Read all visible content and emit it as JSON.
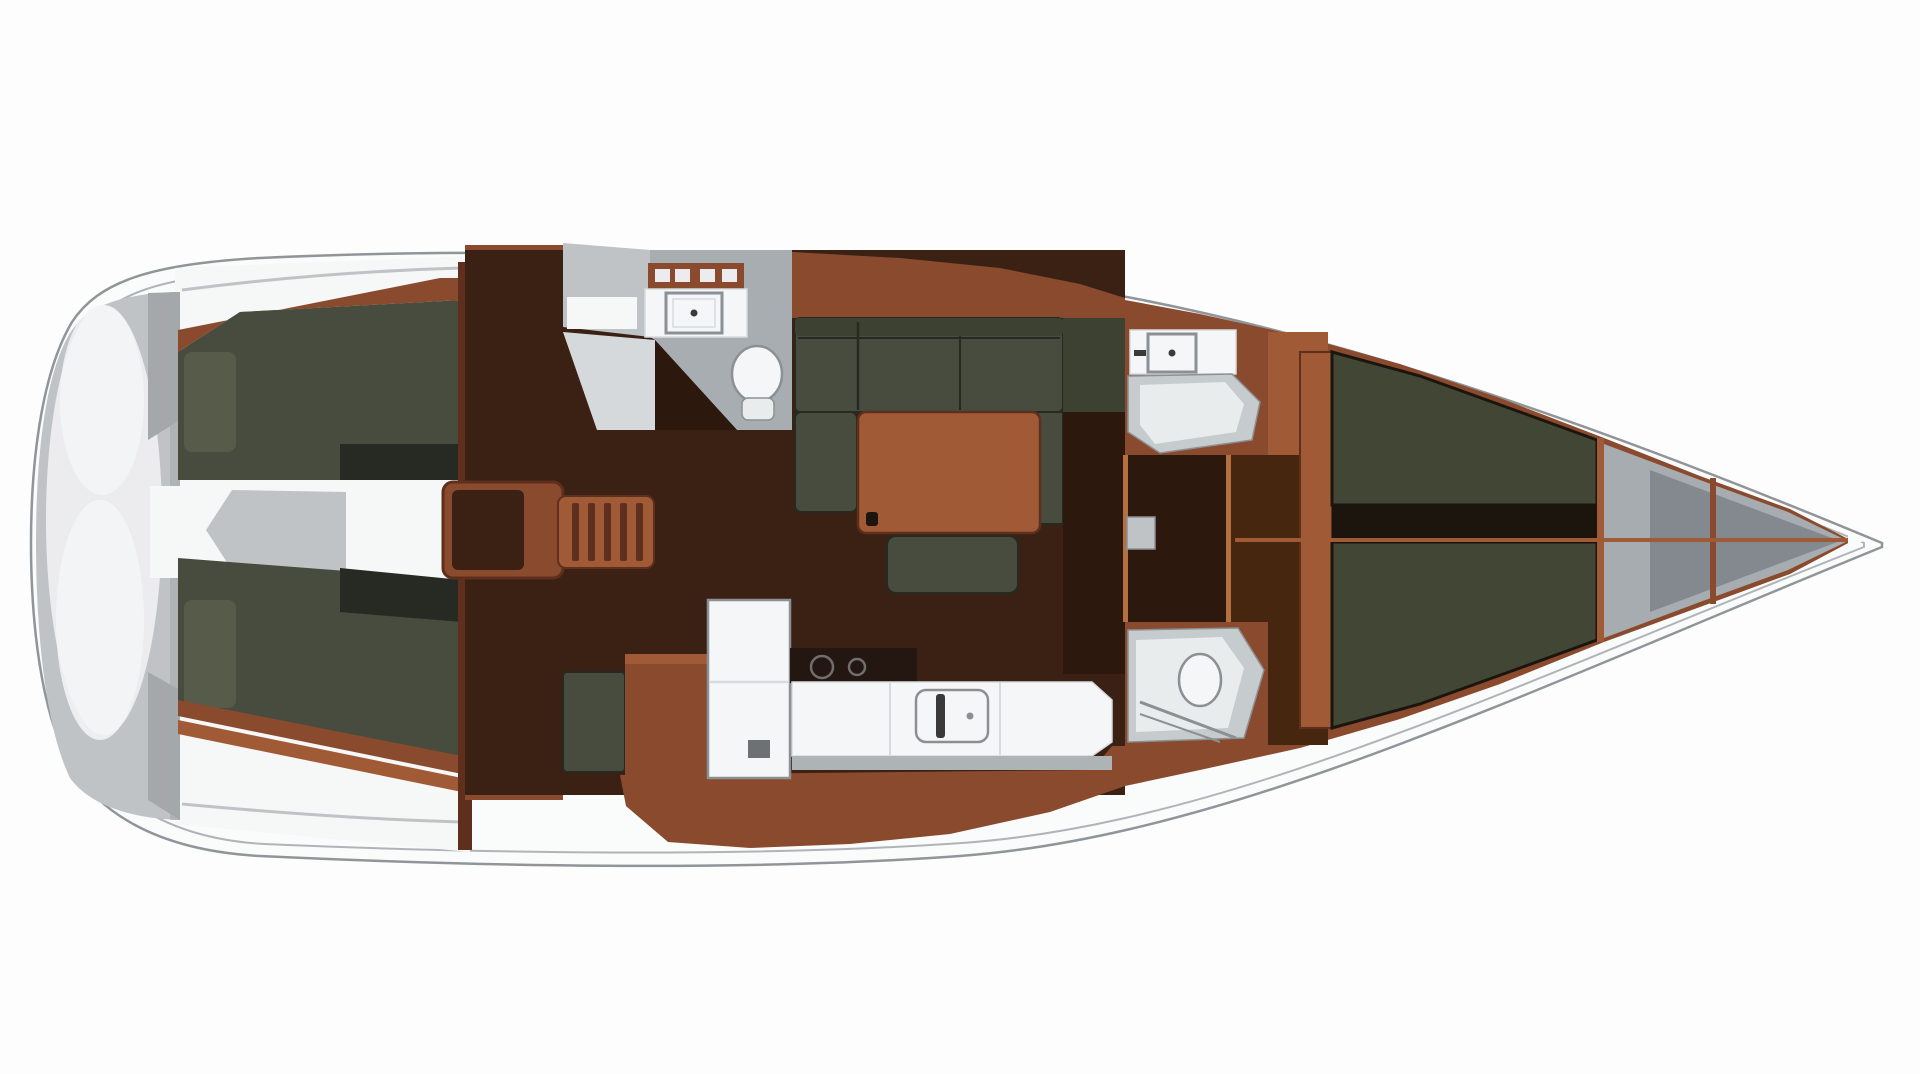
{
  "plan": {
    "type": "yacht-interior-floor-plan",
    "view": "top-down",
    "regions": [
      "stern-platform",
      "port-aft-cabin",
      "starboard-aft-cabin",
      "engine-space",
      "companionway-steps",
      "aft-head",
      "galley",
      "salon-settee",
      "salon-table",
      "salon-ottoman",
      "port-forward-head",
      "starboard-forward-head",
      "corridor",
      "forward-cabin-berth",
      "anchor-locker",
      "bow"
    ]
  },
  "colors": {
    "background": "#fdfdfd",
    "hull_fill": "#fafbfb",
    "hull_line": "#90959a",
    "hull_inner_line": "#b0b4b7",
    "deck_white": "#f6f7f7",
    "silver": "#bfc3c6",
    "silver_dark": "#a4a8ab",
    "silver_light": "#ececee",
    "wood": "#8a4a2e",
    "wood_light": "#a05a36",
    "wood_pale": "#b4713f",
    "wood_dark": "#5d2f1c",
    "wood_deep": "#47260f",
    "sole": "#3b2114",
    "sole_dark": "#2c180c",
    "door_dark": "#331c10",
    "cushion": "#474c3e",
    "cushion_back": "#3c4132",
    "cushion_fwd": "#424735",
    "cushion_light": "#565b4a",
    "cushion_shadow": "#262a23",
    "head_floor": "#a8adb2",
    "shower_gray": "#c6cbce",
    "shower_light": "#e9eced",
    "pale_band": "#d6d9db",
    "fixture_white": "#f4f6f7",
    "fixture_line": "#8b9094",
    "counter_seam": "#d8dbdd",
    "channel_dark": "#1c150e",
    "stove_dark": "#241711",
    "burner_line": "#6f6f6f",
    "faucet_dark": "#3a3a3a",
    "anchor_gray": "#a7acb0",
    "anchor_dark": "#7d8288",
    "fiddle_gray": "#aeb3b6",
    "handle_gray": "#6e7173"
  }
}
